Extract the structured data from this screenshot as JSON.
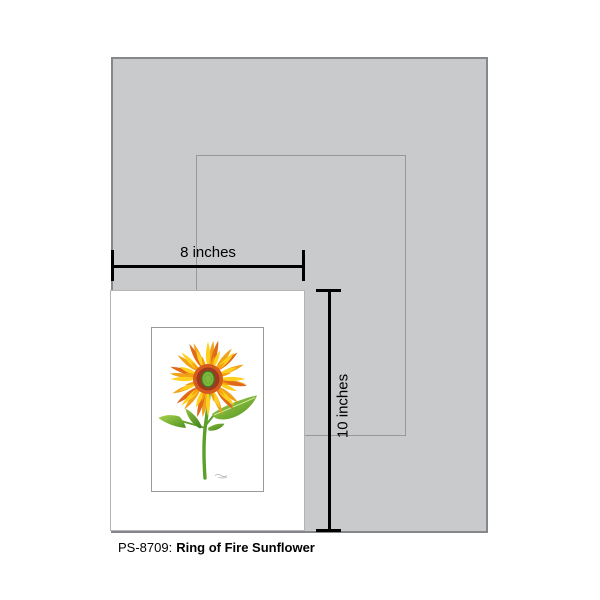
{
  "page": {
    "background": "#ffffff"
  },
  "caption": {
    "sku": "PS-8709:",
    "title": "Ring of Fire Sunflower"
  },
  "measure": {
    "width_label": "8 inches",
    "height_label": "10 inches"
  },
  "size_shapes": {
    "backdrop_fill": "#c9cacc",
    "backdrop_border": "#85878a",
    "outline_border": "#96989b",
    "print_fill": "#ffffff",
    "print_border": "#b3b4b6",
    "art_border": "#9b9b9b",
    "measure_color": "#000000"
  },
  "artwork": {
    "subject": "sunflower",
    "petal_gold": "#F0A21B",
    "petal_yellow": "#FFCF1E",
    "petal_inner": "#F2A00D",
    "petal_orange": "#E06A1A",
    "ring_orange": "#D85B1E",
    "disc_red": "#9E3A1E",
    "center_fill": "#7EB83F",
    "center_stroke": "#3F7A1F",
    "center_texture": "#5C9626",
    "stem_green": "#5CA02A",
    "leaf_light": "#A8D24E",
    "leaf_dark": "#4E9220",
    "leaf_mid": "#8FC23C",
    "leaf_deep": "#3E7D1C",
    "signature_color": "#999999"
  }
}
